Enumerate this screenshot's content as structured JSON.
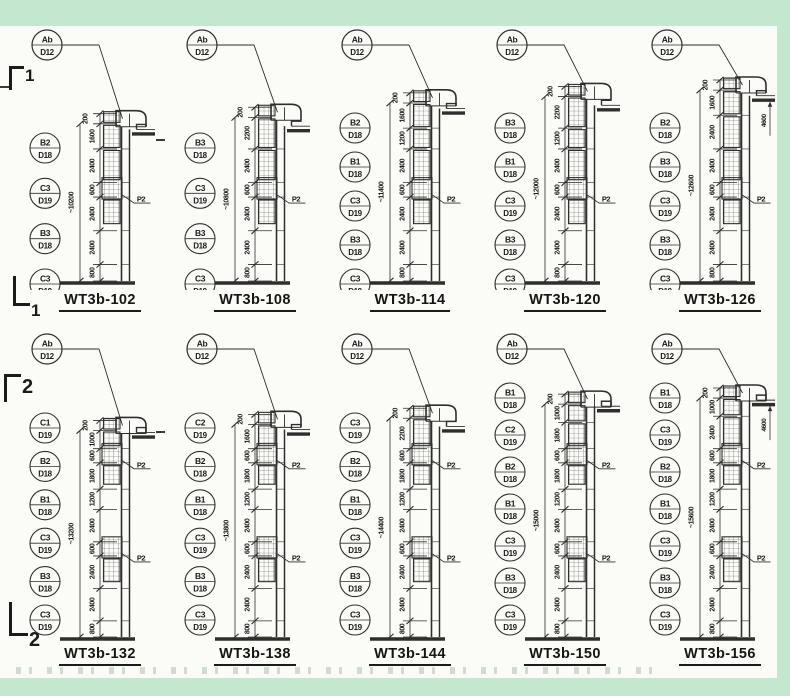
{
  "palette": {
    "margin_band": "#c3e8cf",
    "paper": "#fbfbf7",
    "ink": "#2e2e2e"
  },
  "markers": {
    "row1_top": "1",
    "row1_bottom": "1",
    "row2_top": "2",
    "row2_bottom": "2"
  },
  "detail_label_text": "P2",
  "diagrams": [
    {
      "row": 1,
      "title": "WT3b-102",
      "top_label": {
        "line1": "Ab",
        "line2": "D12"
      },
      "left_labels": [
        {
          "line1": "B2",
          "line2": "D18"
        },
        {
          "line1": "C3",
          "line2": "D19"
        },
        {
          "line1": "B3",
          "line2": "D18"
        },
        {
          "line1": "C3",
          "line2": "D19"
        }
      ],
      "dims_top_to_bottom": [
        200,
        1600,
        2400,
        600,
        2400,
        2400,
        800
      ],
      "overall_dim": "~10200",
      "right_dim": null
    },
    {
      "row": 1,
      "title": "WT3b-108",
      "top_label": {
        "line1": "Ab",
        "line2": "D12"
      },
      "left_labels": [
        {
          "line1": "B3",
          "line2": "D18"
        },
        {
          "line1": "C3",
          "line2": "D19"
        },
        {
          "line1": "B3",
          "line2": "D18"
        },
        {
          "line1": "C3",
          "line2": "D19"
        }
      ],
      "dims_top_to_bottom": [
        200,
        2200,
        2400,
        600,
        2400,
        2400,
        800
      ],
      "overall_dim": "~10800",
      "right_dim": null
    },
    {
      "row": 1,
      "title": "WT3b-114",
      "top_label": {
        "line1": "Ab",
        "line2": "D12"
      },
      "left_labels": [
        {
          "line1": "B2",
          "line2": "D18"
        },
        {
          "line1": "B1",
          "line2": "D18"
        },
        {
          "line1": "C3",
          "line2": "D19"
        },
        {
          "line1": "B3",
          "line2": "D18"
        },
        {
          "line1": "C3",
          "line2": "D19"
        }
      ],
      "dims_top_to_bottom": [
        200,
        1600,
        1200,
        2400,
        600,
        2400,
        2400,
        800
      ],
      "overall_dim": "~11400",
      "right_dim": null
    },
    {
      "row": 1,
      "title": "WT3b-120",
      "top_label": {
        "line1": "Ab",
        "line2": "D12"
      },
      "left_labels": [
        {
          "line1": "B3",
          "line2": "D18"
        },
        {
          "line1": "B1",
          "line2": "D18"
        },
        {
          "line1": "C3",
          "line2": "D19"
        },
        {
          "line1": "B3",
          "line2": "D18"
        },
        {
          "line1": "C3",
          "line2": "D19"
        }
      ],
      "dims_top_to_bottom": [
        200,
        2200,
        1200,
        2400,
        600,
        2400,
        2400,
        800
      ],
      "overall_dim": "~12000",
      "right_dim": null
    },
    {
      "row": 1,
      "title": "WT3b-126",
      "top_label": {
        "line1": "Ab",
        "line2": "D12"
      },
      "left_labels": [
        {
          "line1": "B2",
          "line2": "D18"
        },
        {
          "line1": "B3",
          "line2": "D18"
        },
        {
          "line1": "C3",
          "line2": "D19"
        },
        {
          "line1": "B3",
          "line2": "D18"
        },
        {
          "line1": "C3",
          "line2": "D19"
        }
      ],
      "dims_top_to_bottom": [
        200,
        1600,
        2400,
        2400,
        600,
        2400,
        2400,
        800
      ],
      "overall_dim": "~12600",
      "right_dim": "4600"
    },
    {
      "row": 2,
      "title": "WT3b-132",
      "top_label": {
        "line1": "Ab",
        "line2": "D12"
      },
      "left_labels": [
        {
          "line1": "C1",
          "line2": "D19"
        },
        {
          "line1": "B2",
          "line2": "D18"
        },
        {
          "line1": "B1",
          "line2": "D18"
        },
        {
          "line1": "C3",
          "line2": "D19"
        },
        {
          "line1": "B3",
          "line2": "D18"
        },
        {
          "line1": "C3",
          "line2": "D19"
        }
      ],
      "dims_top_to_bottom": [
        200,
        1000,
        600,
        1800,
        1200,
        2400,
        600,
        2400,
        2400,
        800
      ],
      "overall_dim": "~13200",
      "right_dim": null
    },
    {
      "row": 2,
      "title": "WT3b-138",
      "top_label": {
        "line1": "Ab",
        "line2": "D12"
      },
      "left_labels": [
        {
          "line1": "C2",
          "line2": "D19"
        },
        {
          "line1": "B2",
          "line2": "D18"
        },
        {
          "line1": "B1",
          "line2": "D18"
        },
        {
          "line1": "C3",
          "line2": "D19"
        },
        {
          "line1": "B3",
          "line2": "D18"
        },
        {
          "line1": "C3",
          "line2": "D19"
        }
      ],
      "dims_top_to_bottom": [
        200,
        1600,
        600,
        1800,
        1200,
        2400,
        600,
        2400,
        2400,
        800
      ],
      "overall_dim": "~13800",
      "right_dim": null
    },
    {
      "row": 2,
      "title": "WT3b-144",
      "top_label": {
        "line1": "Ab",
        "line2": "D12"
      },
      "left_labels": [
        {
          "line1": "C3",
          "line2": "D19"
        },
        {
          "line1": "B2",
          "line2": "D18"
        },
        {
          "line1": "B1",
          "line2": "D18"
        },
        {
          "line1": "C3",
          "line2": "D19"
        },
        {
          "line1": "B3",
          "line2": "D18"
        },
        {
          "line1": "C3",
          "line2": "D19"
        }
      ],
      "dims_top_to_bottom": [
        200,
        2200,
        600,
        1800,
        1200,
        2400,
        600,
        2400,
        2400,
        800
      ],
      "overall_dim": "~14400",
      "right_dim": null
    },
    {
      "row": 2,
      "title": "WT3b-150",
      "top_label": {
        "line1": "Ab",
        "line2": "D12"
      },
      "left_labels": [
        {
          "line1": "B1",
          "line2": "D18"
        },
        {
          "line1": "C2",
          "line2": "D19"
        },
        {
          "line1": "B2",
          "line2": "D18"
        },
        {
          "line1": "B1",
          "line2": "D18"
        },
        {
          "line1": "C3",
          "line2": "D19"
        },
        {
          "line1": "B3",
          "line2": "D18"
        },
        {
          "line1": "C3",
          "line2": "D19"
        }
      ],
      "dims_top_to_bottom": [
        200,
        1000,
        1800,
        600,
        1800,
        1200,
        2400,
        600,
        2400,
        2400,
        800
      ],
      "overall_dim": "~15000",
      "right_dim": null
    },
    {
      "row": 2,
      "title": "WT3b-156",
      "top_label": {
        "line1": "Ab",
        "line2": "D12"
      },
      "left_labels": [
        {
          "line1": "B1",
          "line2": "D18"
        },
        {
          "line1": "C3",
          "line2": "D19"
        },
        {
          "line1": "B2",
          "line2": "D18"
        },
        {
          "line1": "B1",
          "line2": "D18"
        },
        {
          "line1": "C3",
          "line2": "D19"
        },
        {
          "line1": "B3",
          "line2": "D18"
        },
        {
          "line1": "C3",
          "line2": "D19"
        }
      ],
      "dims_top_to_bottom": [
        200,
        1000,
        2400,
        600,
        1800,
        1200,
        2400,
        600,
        2400,
        2400,
        800
      ],
      "overall_dim": "~15600",
      "right_dim": "4600"
    }
  ]
}
